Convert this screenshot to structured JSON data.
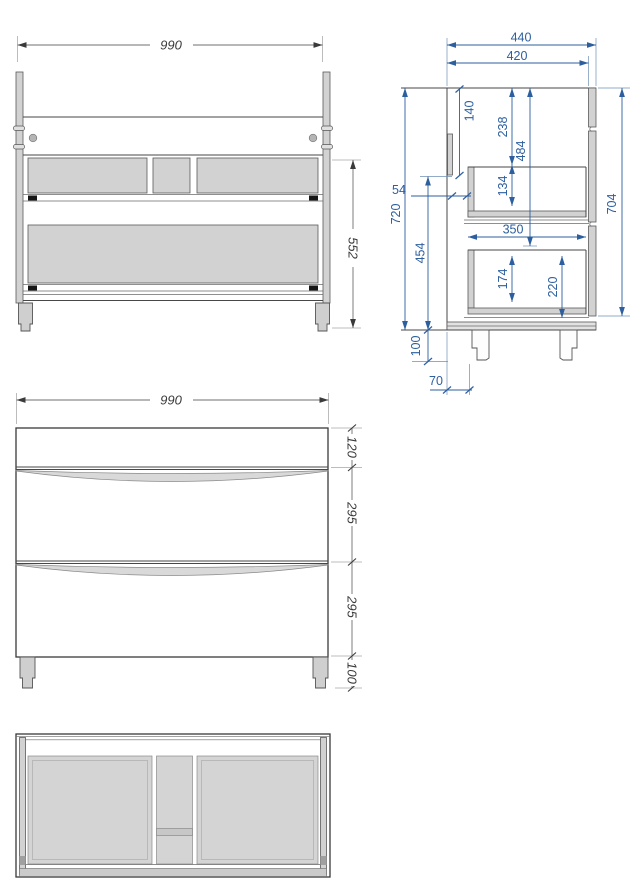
{
  "views": {
    "front_frame": {
      "width": "990",
      "height": "552"
    },
    "side": {
      "depth_overall": "440",
      "depth_carcass": "420",
      "back_top_gap": "140",
      "top_to_drawer": "238",
      "top_to_divider": "484",
      "upper_drawer_inner": "134",
      "back_clearance": "54",
      "inner_height": "720",
      "drawer_zone_height": "454",
      "drawer_depth": "350",
      "lower_drawer_inner": "174",
      "lower_drawer_height": "220",
      "body_height": "704",
      "leg_height": "100",
      "leg_setback": "70"
    },
    "front": {
      "width": "990",
      "top_panel": "120",
      "upper_drawer": "295",
      "lower_drawer": "295",
      "legs": "100"
    }
  },
  "colors": {
    "dimension_blue": "#2d5f9f",
    "drawing_black": "#3a3a3a",
    "panel_gray": "#d2d2d2"
  }
}
